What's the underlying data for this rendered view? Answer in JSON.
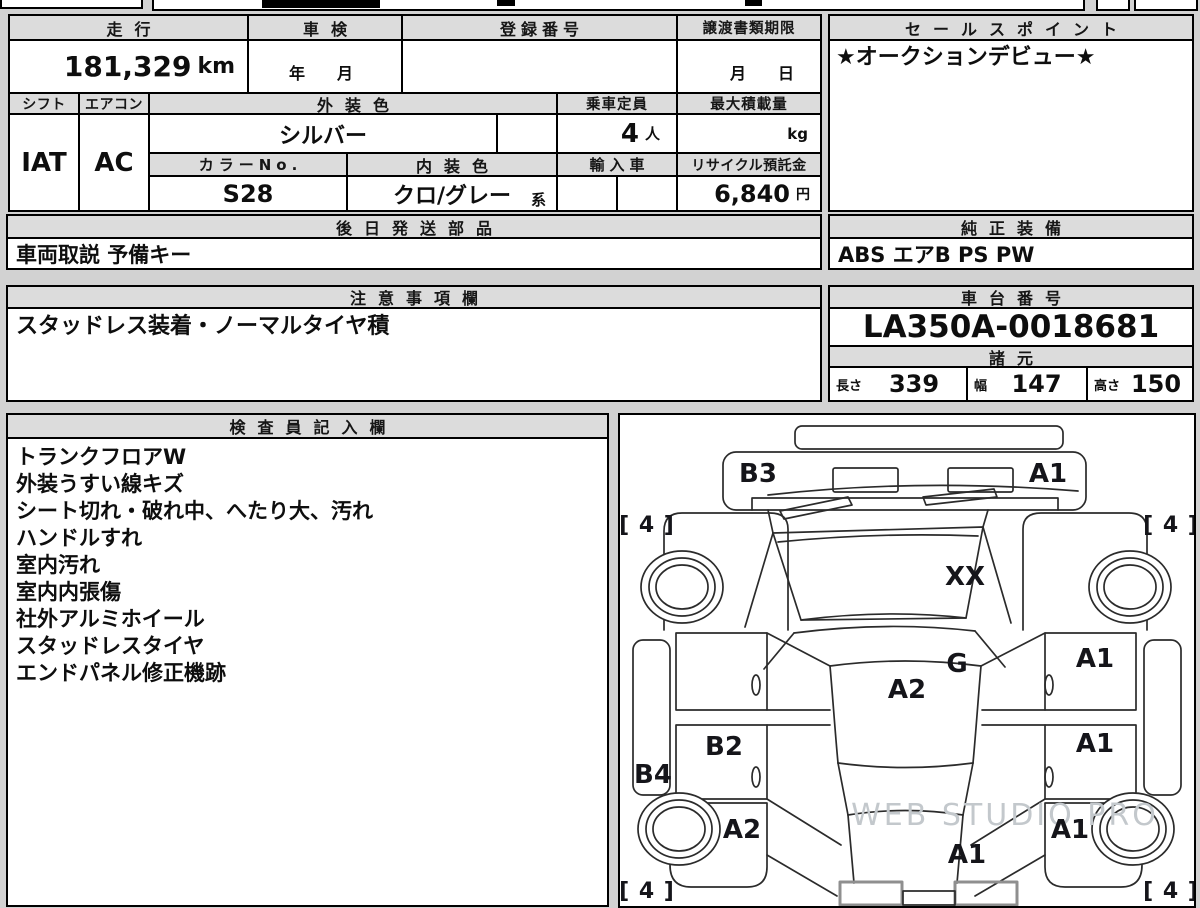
{
  "fields": {
    "mileage": {
      "label": "走行",
      "value": "181,329",
      "unit": "km"
    },
    "inspection": {
      "label": "車検",
      "value": "年　月"
    },
    "registration": {
      "label": "登録番号",
      "value": ""
    },
    "transfer_docs_deadline": {
      "label": "譲渡書類期限",
      "value": "月　日"
    },
    "shift": {
      "label": "シフト",
      "value": "IAT"
    },
    "aircon": {
      "label": "エアコン",
      "value": "AC"
    },
    "exterior_color": {
      "label": "外装色",
      "value": "シルバー"
    },
    "passenger_capacity": {
      "label": "乗車定員",
      "value": "4",
      "unit": "人"
    },
    "max_load": {
      "label": "最大積載量",
      "value": "",
      "unit": "kg"
    },
    "color_no": {
      "label": "カラーNo.",
      "value": "S28"
    },
    "interior_color": {
      "label": "内装色",
      "value": "クロ/グレー",
      "suffix": "系"
    },
    "imported": {
      "label": "輸入車",
      "value": ""
    },
    "recycle_deposit": {
      "label": "リサイクル預託金",
      "value": "6,840",
      "unit": "円"
    },
    "parts_shipped_later": {
      "label": "後日発送部品",
      "value": "車両取説 予備キー"
    },
    "sales_point": {
      "label": "セールスポイント",
      "value": "★オークションデビュー★"
    },
    "genuine_equipment": {
      "label": "純正装備",
      "value": "ABS エアB PS PW"
    },
    "cautions": {
      "label": "注意事項欄",
      "value": "スタッドレス装着・ノーマルタイヤ積"
    },
    "chassis_no": {
      "label": "車台番号",
      "value": "LA350A-0018681"
    },
    "dimensions": {
      "label": "諸元",
      "length": {
        "label": "長さ",
        "value": "339"
      },
      "width": {
        "label": "幅",
        "value": "147"
      },
      "height": {
        "label": "高さ",
        "value": "150"
      }
    }
  },
  "inspector_notes": {
    "label": "検査員記入欄",
    "lines": [
      "トランクフロアW",
      "外装うすい線キズ",
      "シート切れ・破れ中、へたり大、汚れ",
      "ハンドルすれ",
      "室内汚れ",
      "室内内張傷",
      "社外アルミホイール",
      "スタッドレスタイヤ",
      "エンドパネル修正機跡"
    ]
  },
  "diagram": {
    "watermark": "WEB STUDIO PRO",
    "panel_labels": [
      {
        "text": "B3",
        "x": 138,
        "y": 67
      },
      {
        "text": "A1",
        "x": 428,
        "y": 67
      },
      {
        "text": "XX",
        "x": 345,
        "y": 170
      },
      {
        "text": "G",
        "x": 337,
        "y": 257
      },
      {
        "text": "A2",
        "x": 287,
        "y": 283
      },
      {
        "text": "A1",
        "x": 475,
        "y": 252
      },
      {
        "text": "B2",
        "x": 104,
        "y": 340
      },
      {
        "text": "A1",
        "x": 475,
        "y": 337
      },
      {
        "text": "B4",
        "x": 33,
        "y": 368
      },
      {
        "text": "A2",
        "x": 122,
        "y": 423
      },
      {
        "text": "A1",
        "x": 450,
        "y": 423
      },
      {
        "text": "A1",
        "x": 347,
        "y": 448
      },
      {
        "text": "[ 4 ]",
        "x": 27,
        "y": 117,
        "small": true
      },
      {
        "text": "[ 4 ]",
        "x": 551,
        "y": 117,
        "small": true
      },
      {
        "text": "[ 4 ]",
        "x": 27,
        "y": 483,
        "small": true
      },
      {
        "text": "[ 4 ]",
        "x": 551,
        "y": 483,
        "small": true
      }
    ]
  }
}
